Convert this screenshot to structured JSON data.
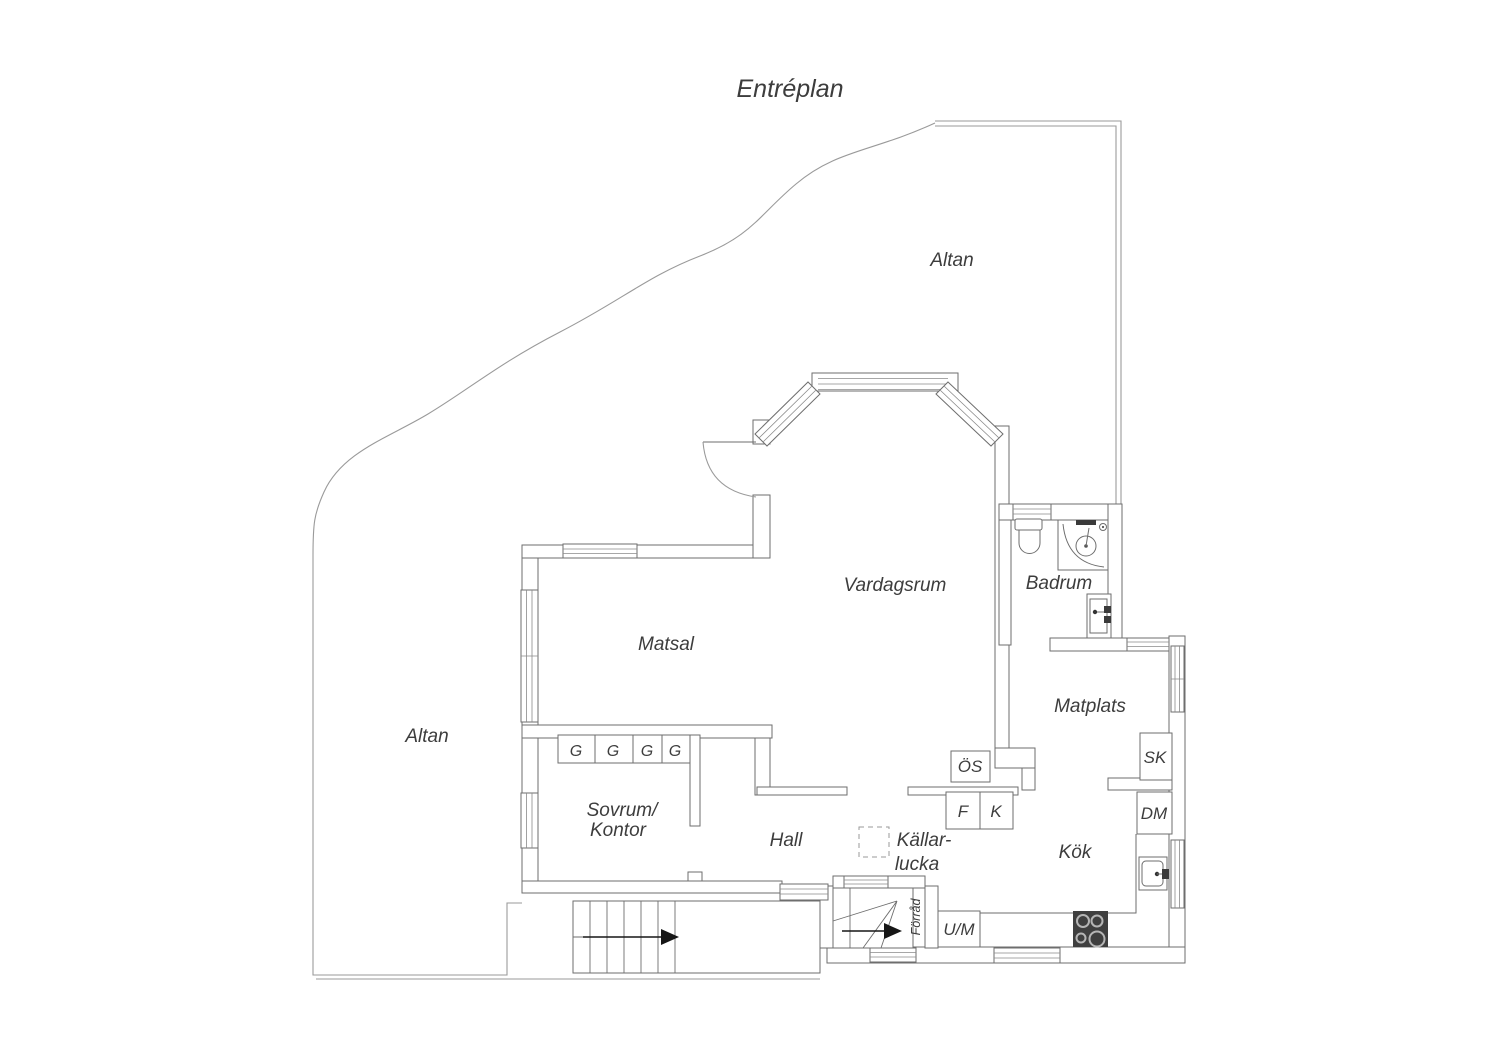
{
  "title": "Entréplan",
  "colors": {
    "background": "#ffffff",
    "wall_line": "#6e6e6e",
    "terrace_line": "#9a9a9a",
    "text": "#3d3d3d",
    "stove": "#3f3f3f",
    "arrow": "#161616"
  },
  "rooms": {
    "altan_top": "Altan",
    "altan_left": "Altan",
    "vardagsrum": "Vardagsrum",
    "matsal": "Matsal",
    "badrum": "Badrum",
    "matplats": "Matplats",
    "hall": "Hall",
    "kok": "Kök",
    "sovrum_line1": "Sovrum/",
    "sovrum_line2": "Kontor",
    "kallarlucka_line1": "Källar-",
    "kallarlucka_line2": "lucka"
  },
  "fixtures": {
    "wardrobe": "G",
    "os": "ÖS",
    "fridge": "F",
    "freezer": "K",
    "sk": "SK",
    "dm": "DM",
    "um": "U/M",
    "forrad": "Förråd"
  }
}
